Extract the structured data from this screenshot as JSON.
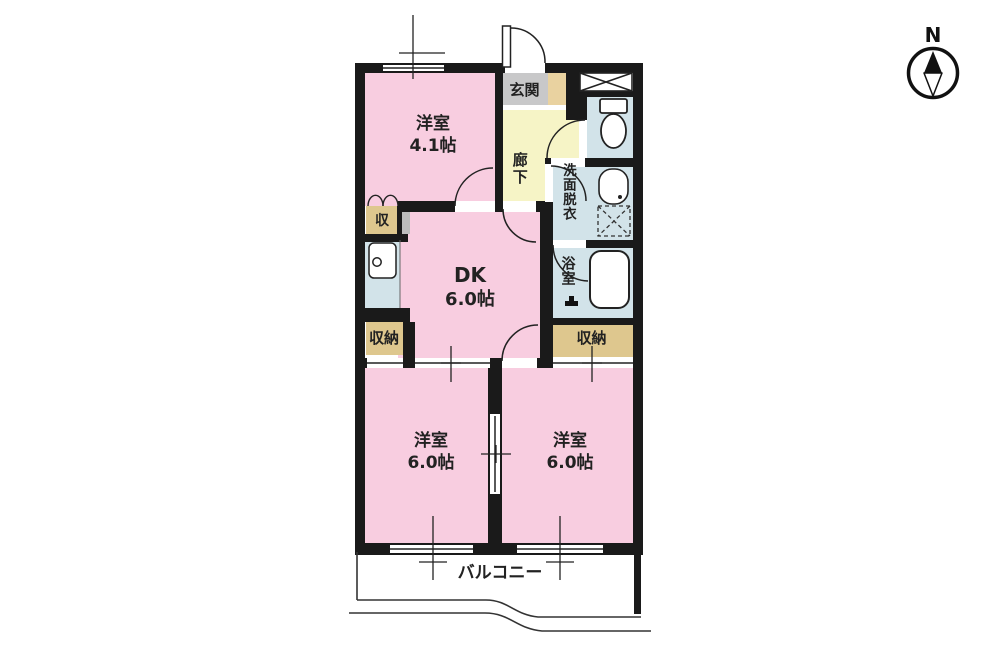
{
  "plan": {
    "compass": {
      "north_label": "N"
    },
    "rooms": {
      "bedroom_top": {
        "name": "洋室",
        "size": "4.1帖"
      },
      "entrance": {
        "label": "玄関"
      },
      "hallway": {
        "label": "廊下"
      },
      "washroom": {
        "label": "洗面脱衣"
      },
      "bathroom": {
        "label": "浴室"
      },
      "dining_kitchen": {
        "name": "DK",
        "size": "6.0帖"
      },
      "closet_top": {
        "label": "収"
      },
      "closet_left": {
        "label": "収納"
      },
      "closet_right": {
        "label": "収納"
      },
      "bedroom_left": {
        "name": "洋室",
        "size": "6.0帖"
      },
      "bedroom_right": {
        "name": "洋室",
        "size": "6.0帖"
      },
      "balcony": {
        "label": "バルコニー"
      }
    },
    "colors": {
      "room_pink": "#f8cde0",
      "hall_yellow": "#f6f4c6",
      "wet_area_blue": "#d2e3e9",
      "closet_tan": "#dec78e",
      "entrance_gray": "#c8c8c9",
      "entrance_step_tan": "#e9d2a0",
      "wall_black": "#1a1a1a"
    }
  }
}
